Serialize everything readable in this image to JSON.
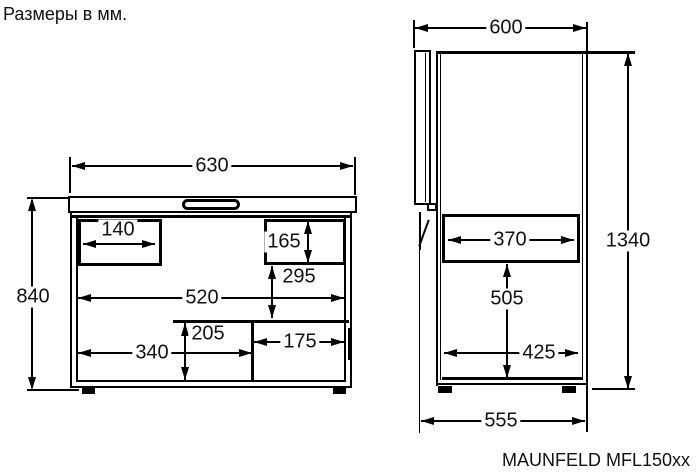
{
  "page": {
    "title": "Размеры в мм.",
    "model": "MAUNFELD MFL150xx"
  },
  "front_view": {
    "top_width": "630",
    "height": "840",
    "left_pocket_width": "140",
    "right_pocket_height": "165",
    "right_pocket_offset": "295",
    "inner_width": "520",
    "step_height": "205",
    "floor_width": "340",
    "step_width": "175"
  },
  "side_view": {
    "top_depth": "600",
    "open_height": "1340",
    "upper_depth": "370",
    "inner_height": "505",
    "lower_depth": "425",
    "base_depth": "555"
  }
}
